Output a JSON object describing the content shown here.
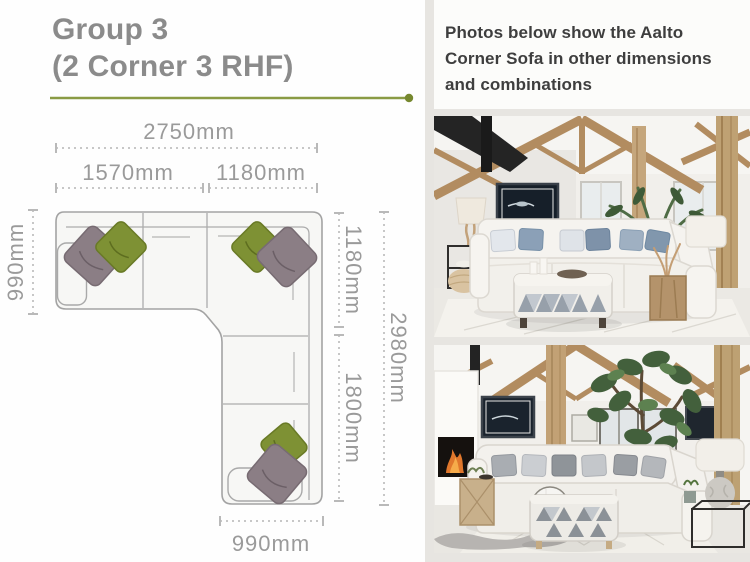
{
  "left_panel": {
    "title_line1": "Group 3",
    "title_line2": "(2 Corner 3 RHF)",
    "diagram_labels": {
      "overall_width": "2750mm",
      "left_section_width": "1570mm",
      "corner_section_width": "1180mm",
      "left_depth": "990mm",
      "right_upper_depth": "1180mm",
      "right_lower_depth": "1800mm",
      "overall_depth": "2980mm",
      "bottom_width": "990mm"
    }
  },
  "right_panel": {
    "caption": "Photos below show the Aalto Corner Sofa in other dimensions and combinations"
  },
  "colors": {
    "accent_olive": "#8a9b44",
    "cushion_olive": "#7e9134",
    "cushion_grey": "#8b7e85",
    "title_grey": "#8b8b8b",
    "dimension_grey": "#9a9a9a",
    "caption_text": "#3e3e3e",
    "panel_bg": "#e7e5e1"
  }
}
